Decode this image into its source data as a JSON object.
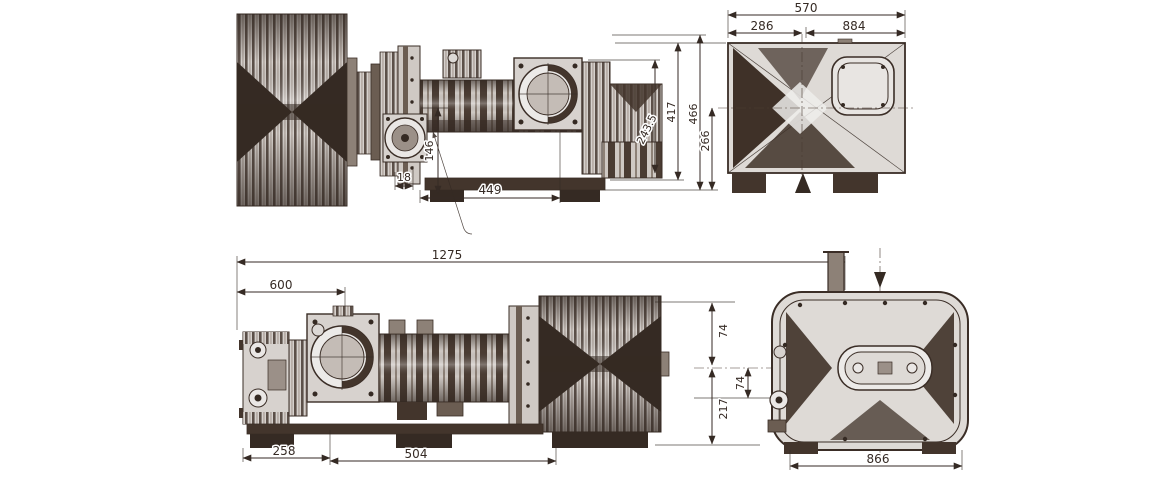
{
  "colors": {
    "line": "#3a2d26",
    "fill_light": "#dcd8d5",
    "fill_mid": "#8d8177",
    "fill_dark": "#43352c",
    "shadow": "#352a23",
    "background": "#ffffff"
  },
  "dims": {
    "top": {
      "d570": "570",
      "d286": "286",
      "d884": "884",
      "d243_5": "243.5",
      "d417": "417",
      "d466": "466",
      "d266": "266",
      "d146": "146",
      "d18": "18",
      "d449": "449"
    },
    "bottom": {
      "d1275": "1275",
      "d600": "600",
      "d258": "258",
      "d504": "504",
      "d74a": "74",
      "d74b": "74",
      "d217": "217",
      "d866": "866"
    }
  }
}
